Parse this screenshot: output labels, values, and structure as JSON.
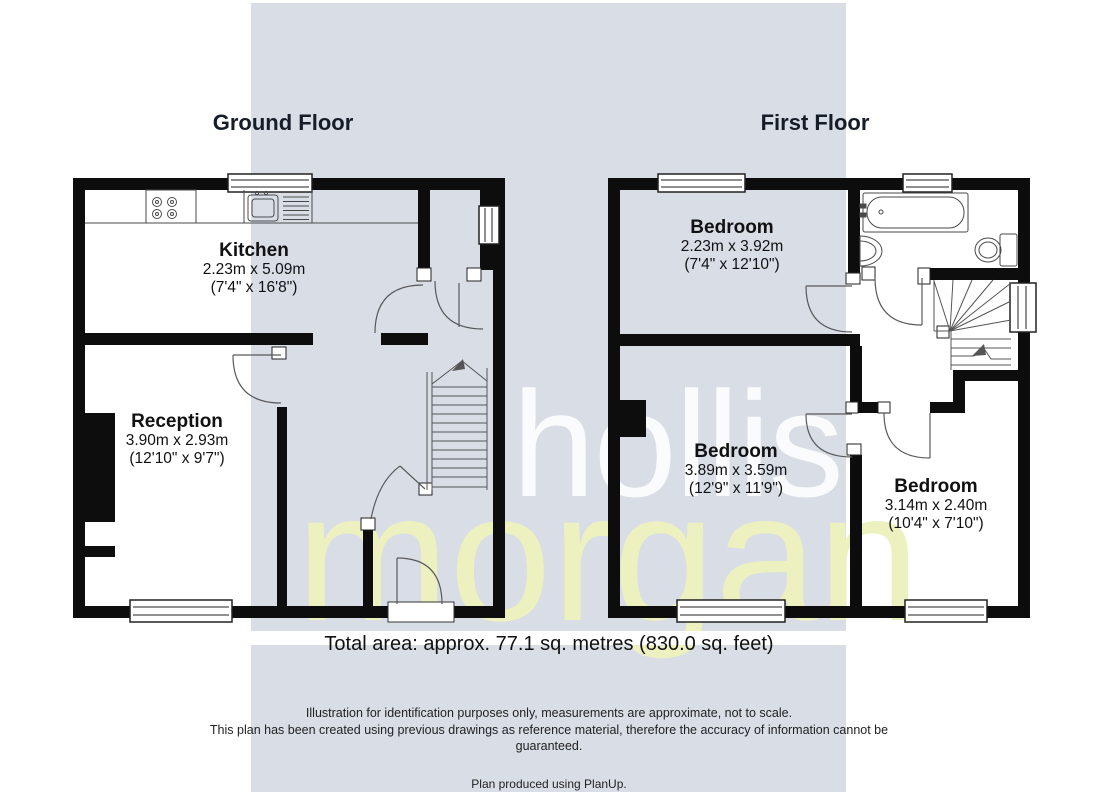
{
  "watermark": {
    "line1": "hollis",
    "line2": "morgan",
    "band_color": "#d8dde6",
    "line1_color": "#ffffff",
    "line2_color": "#ecf1bf"
  },
  "floors": [
    {
      "title": "Ground Floor",
      "rooms": [
        {
          "name": "Kitchen",
          "metric": "2.23m x 5.09m",
          "imperial": "(7'4\" x 16'8\")"
        },
        {
          "name": "Reception",
          "metric": "3.90m x 2.93m",
          "imperial": "(12'10\" x 9'7\")"
        }
      ]
    },
    {
      "title": "First Floor",
      "rooms": [
        {
          "name": "Bedroom",
          "metric": "2.23m x 3.92m",
          "imperial": "(7'4\" x 12'10\")"
        },
        {
          "name": "Bedroom",
          "metric": "3.89m x 3.59m",
          "imperial": "(12'9\" x 11'9\")"
        },
        {
          "name": "Bedroom",
          "metric": "3.14m x 2.40m",
          "imperial": "(10'4\" x 7'10\")"
        }
      ]
    }
  ],
  "footer": {
    "total_area": "Total area: approx. 77.1 sq. metres (830.0 sq. feet)",
    "disclaimer_line1": "Illustration for identification purposes only, measurements are approximate, not to scale.",
    "disclaimer_line2": "This plan has been created using previous drawings as reference material, therefore the accuracy of information cannot be",
    "disclaimer_line3": "guaranteed.",
    "produced": "Plan produced using PlanUp."
  }
}
